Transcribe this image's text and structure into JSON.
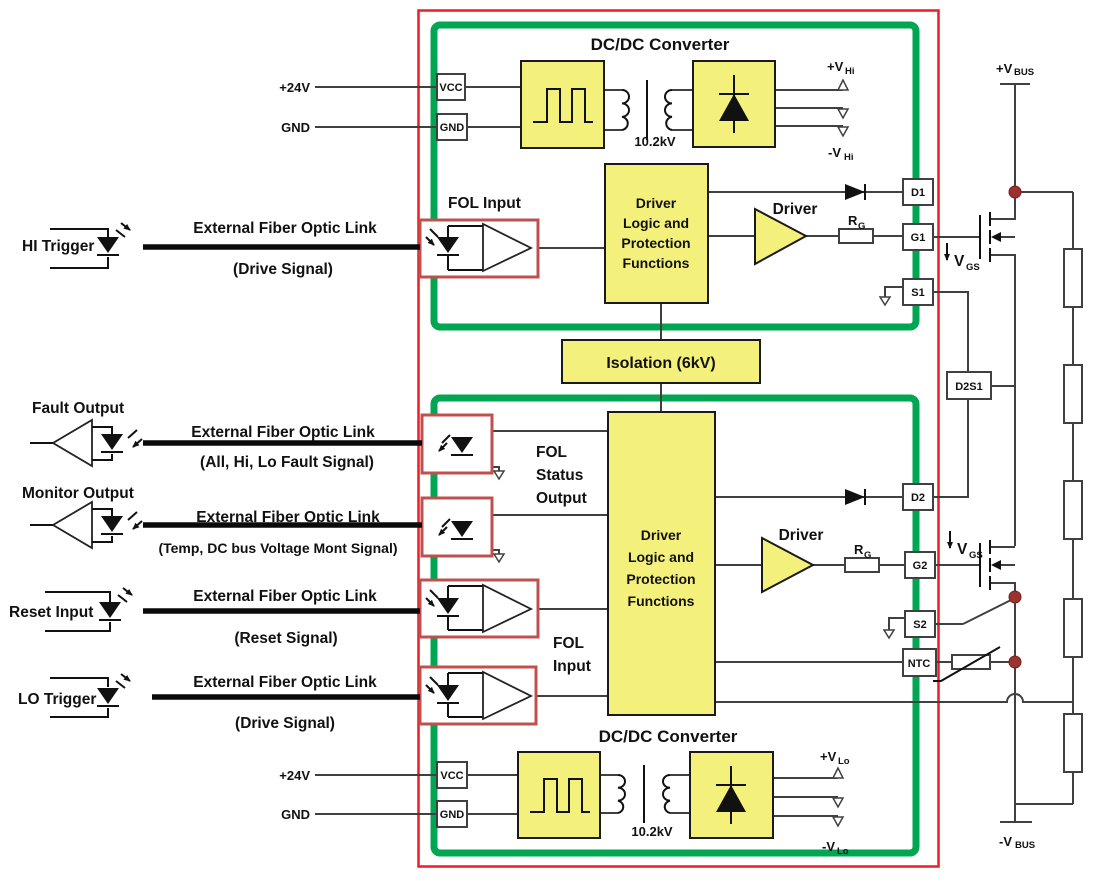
{
  "titles": {
    "dcdc_top": "DC/DC Converter",
    "dcdc_bottom": "DC/DC Converter",
    "isolation": "Isolation (6kV)"
  },
  "converters": {
    "top": {
      "in_pwr": "+24V",
      "in_gnd": "GND",
      "vcc": "VCC",
      "gnd": "GND",
      "kv": "10.2kV",
      "vp_main": "+V",
      "vp_sub": "Hi",
      "vn_main": "-V",
      "vn_sub": "Hi"
    },
    "bottom": {
      "in_pwr": "+24V",
      "in_gnd": "GND",
      "vcc": "VCC",
      "gnd": "GND",
      "kv": "10.2kV",
      "vp_main": "+V",
      "vp_sub": "Lo",
      "vn_main": "-V",
      "vn_sub": "Lo"
    }
  },
  "logic": {
    "line1": "Driver",
    "line2": "Logic and",
    "line3": "Protection",
    "line4": "Functions"
  },
  "driver": {
    "label": "Driver",
    "rg_main": "R",
    "rg_sub": "G"
  },
  "fol": {
    "input_top": "FOL Input",
    "status1": "FOL",
    "status2": "Status",
    "status3": "Output",
    "input1": "FOL",
    "input2": "Input"
  },
  "terminals": {
    "d1": "D1",
    "g1": "G1",
    "s1": "S1",
    "d2s1": "D2S1",
    "d2": "D2",
    "g2": "G2",
    "s2": "S2",
    "ntc": "NTC"
  },
  "bus": {
    "vbus_p_main": "+V",
    "vbus_p_sub": "BUS",
    "vbus_n_main": "-V",
    "vbus_n_sub": "BUS",
    "vgs_main": "V",
    "vgs_sub": "GS"
  },
  "links": [
    {
      "name": "HI Trigger",
      "title": "External Fiber Optic Link",
      "subtitle": "(Drive Signal)"
    },
    {
      "name": "Fault Output",
      "title": "External Fiber Optic Link",
      "subtitle": "(All, Hi, Lo Fault Signal)"
    },
    {
      "name": "Monitor Output",
      "title": "External Fiber Optic Link",
      "subtitle": "(Temp, DC bus Voltage Mont Signal)"
    },
    {
      "name": "Reset Input",
      "title": "External Fiber Optic Link",
      "subtitle": "(Reset Signal)"
    },
    {
      "name": "LO Trigger",
      "title": "External Fiber Optic Link",
      "subtitle": "(Drive Signal)"
    }
  ],
  "colors": {
    "yellow": "#f4f07c",
    "green": "#00a651",
    "red_frame": "#ee1c25",
    "red_fol": "#c0504d",
    "dot": "#9c3230",
    "wire": "#404040"
  }
}
